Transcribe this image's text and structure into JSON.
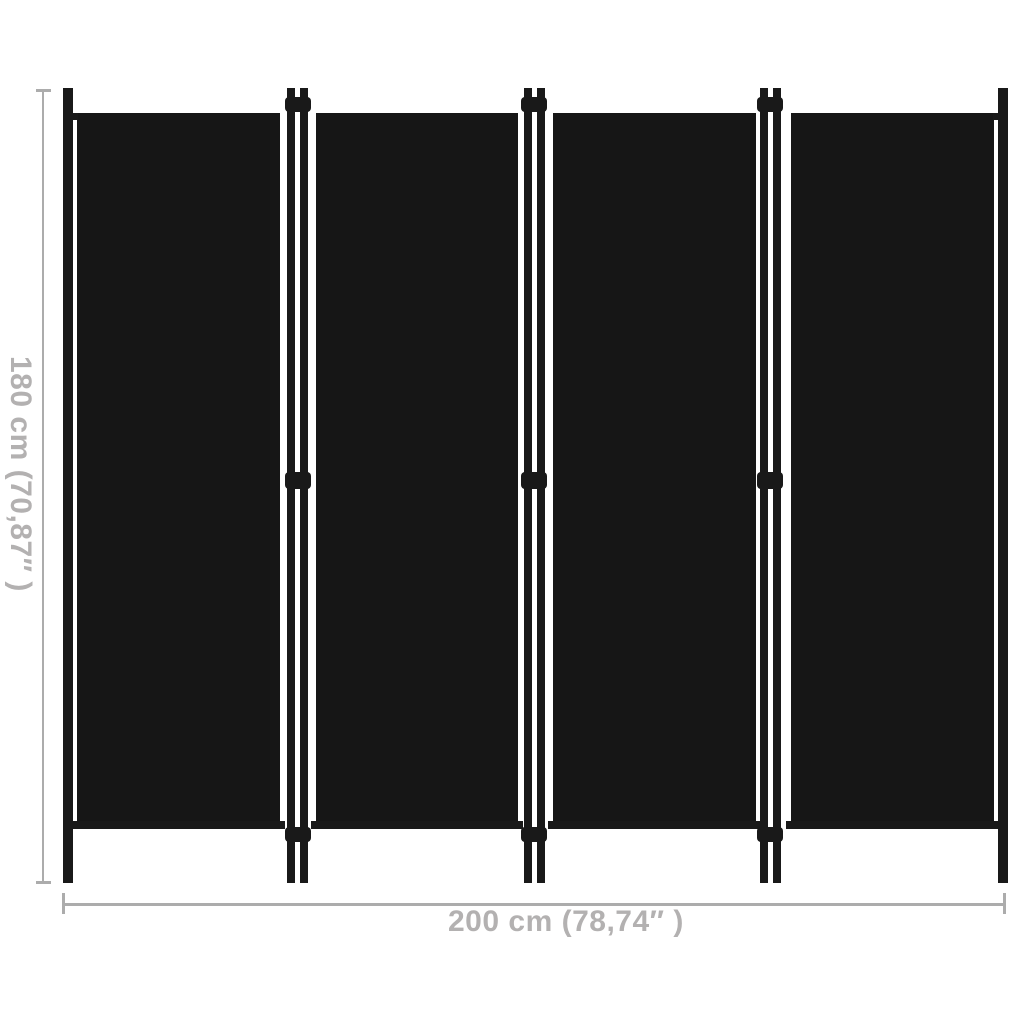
{
  "product": {
    "name": "4-panel room divider",
    "panel_count": 4,
    "panel_color_name": "black"
  },
  "dimensions": {
    "height_label": "180 cm (70,87″ )",
    "width_label": "200 cm (78,74″ )"
  },
  "colors": {
    "background": "#ffffff",
    "panel_fabric": "#161616",
    "frame": "#191919",
    "dimension_line": "#acacac",
    "dimension_text": "#b3b1b1"
  }
}
